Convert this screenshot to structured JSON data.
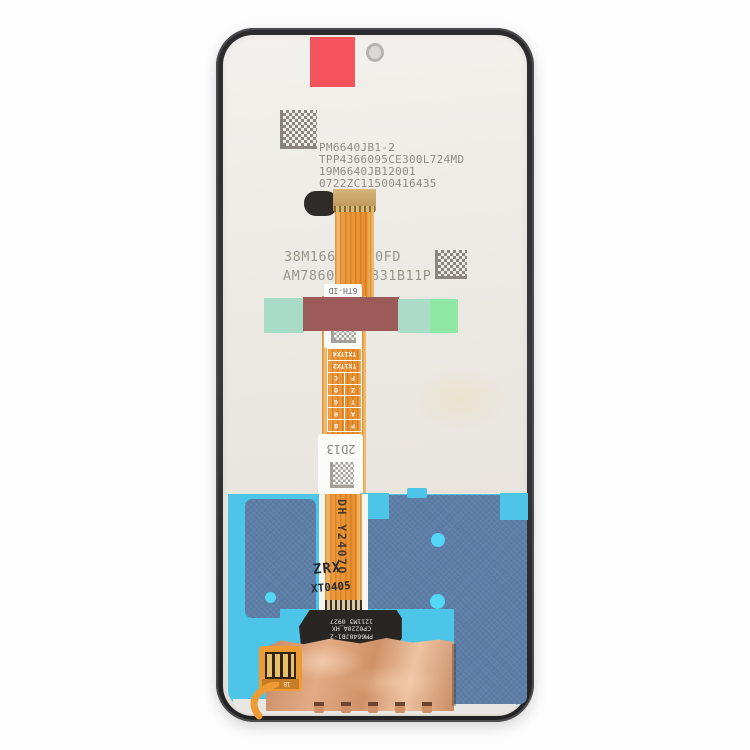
{
  "product": {
    "description": "Rear view of a phone LCD screen and digitizer assembly replacement part, product photo on white background"
  },
  "printed_codes": {
    "top_block": [
      "PM6640JB1-2",
      "TPP4366095CE300L724MD",
      "19M6640JB12001",
      "0722ZC11500416435"
    ],
    "mid_line1_left": "38M166",
    "mid_line1_right": "0FD",
    "mid_line2_left": "AM7860",
    "mid_line2_right": "831B11P"
  },
  "flex_labels": {
    "small_label_top": "6TH-ID",
    "grid_rows": [
      [
        "P",
        "B"
      ],
      [
        "A",
        "H"
      ],
      [
        "T",
        "G"
      ],
      [
        "Z",
        "D"
      ],
      [
        "F",
        "C"
      ],
      [
        "TX1TX2"
      ],
      [
        "TX1TX4"
      ]
    ],
    "grid_note": "rendered rotated 180deg; reads TX1TX4 / TX1TX2 first in photo orientation",
    "label_2d13": "2D13",
    "cable_vertical_code": "DH Y2407Q",
    "stamp_line1": "ZRX",
    "stamp_line2": "XT0405",
    "black_strip_lines": [
      "PM6640JB1-2",
      "CP0220A_HX",
      "1211M3 0927"
    ],
    "connector_code": "1B"
  },
  "icons": {
    "qr_top": "datamatrix-code",
    "qr_mid": "datamatrix-code",
    "qr_label_small": "datamatrix-code",
    "camera_hole": "camera-hole"
  },
  "colors": {
    "frame": "#323234",
    "back_panel": "#eae6e0",
    "red_sticker": "#f6545c",
    "cable_orange": "#ec9a3e",
    "tape_mint": "#a8dcc6",
    "tape_mauve": "#9c5a58",
    "tape_green": "#8fe9a5",
    "blue_field": "#4cc5e9",
    "blue_gray_panel": "#5d7ea7",
    "cyan_dot": "#52d7f6",
    "copper_foil": "#d59a74",
    "print_gray": "#8f8b84"
  }
}
